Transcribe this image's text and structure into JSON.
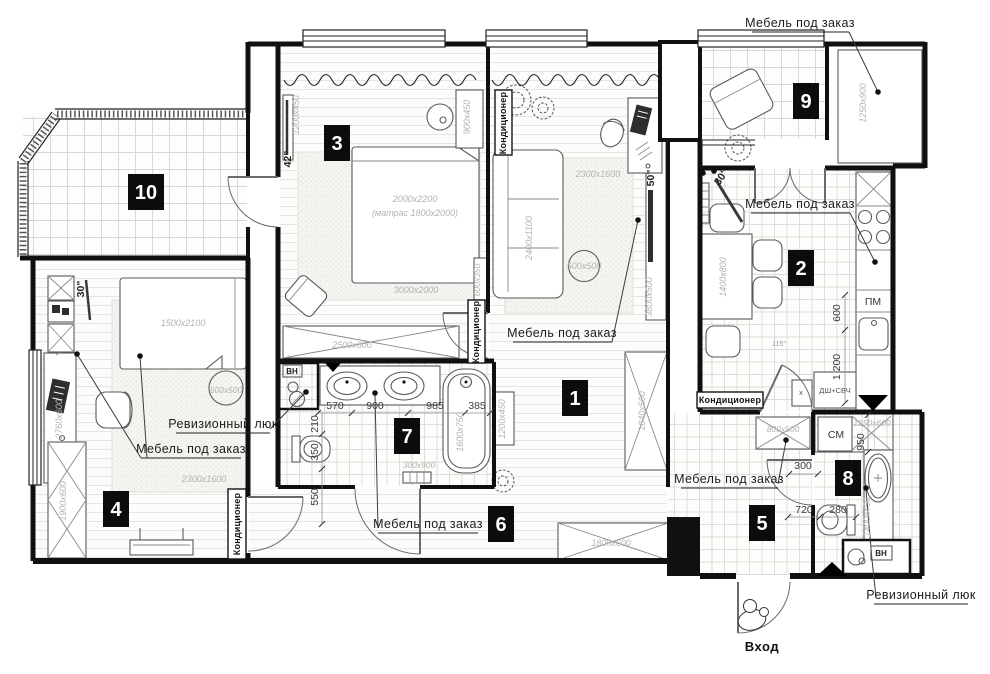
{
  "rooms": {
    "r1": "1",
    "r2": "2",
    "r3": "3",
    "r4": "4",
    "r5": "5",
    "r6": "6",
    "r7": "7",
    "r8": "8",
    "r9": "9",
    "r10": "10"
  },
  "notes": {
    "custom_furniture": "Мебель под заказ",
    "inspection_hatch": "Ревизионный люк",
    "air_conditioner": "Кондиционер",
    "entrance": "Вход",
    "angle_115": "115°"
  },
  "appliances": {
    "dishwasher": "ПМ",
    "washing_machine": "СМ",
    "water_heater": "ВН",
    "oven_microwave": "ДШ+СВЧ",
    "sink_mark": "х",
    "tv42": "42\"",
    "tv50": "50\"",
    "tv30": "30\""
  },
  "furniture_dims": {
    "bed3_size": "2000x2200",
    "bed3_mattress": "(матрас 1800x2000)",
    "rug3": "3000x2000",
    "wardrobe3": "2500x600",
    "shelf3": "900x450",
    "tv_unit3": "1200x450",
    "shelf3b": "600x350",
    "sofa": "2400x1100",
    "rug_living": "2300x1600",
    "coffee_table": "500x500",
    "media_unit": "3800x500",
    "wardrobe_living": "1840x500",
    "kitchen_table": "1400x800",
    "loggia_cabinet": "1250x900",
    "bed4": "1500x2100",
    "rug4": "2300x1600",
    "pouf4": "500x500",
    "desk4": "2760x600",
    "wardrobe4": "1900x600",
    "hall_wardrobe": "1800x600",
    "hall_cabinet": "1200x450",
    "hall_shelf": "800x500",
    "bath_counter": "1250x600",
    "bath_tub8": "1400x450",
    "bath_tub7": "1600x750",
    "bath_mat": "300x900"
  },
  "dimensions": {
    "d570": "570",
    "d900": "900",
    "d985": "985",
    "d385": "385",
    "d210": "210",
    "d350": "350",
    "d550": "550",
    "d600": "600",
    "d1200": "1 200",
    "d300": "300",
    "d720": "720",
    "d280": "280",
    "d950": "950"
  }
}
